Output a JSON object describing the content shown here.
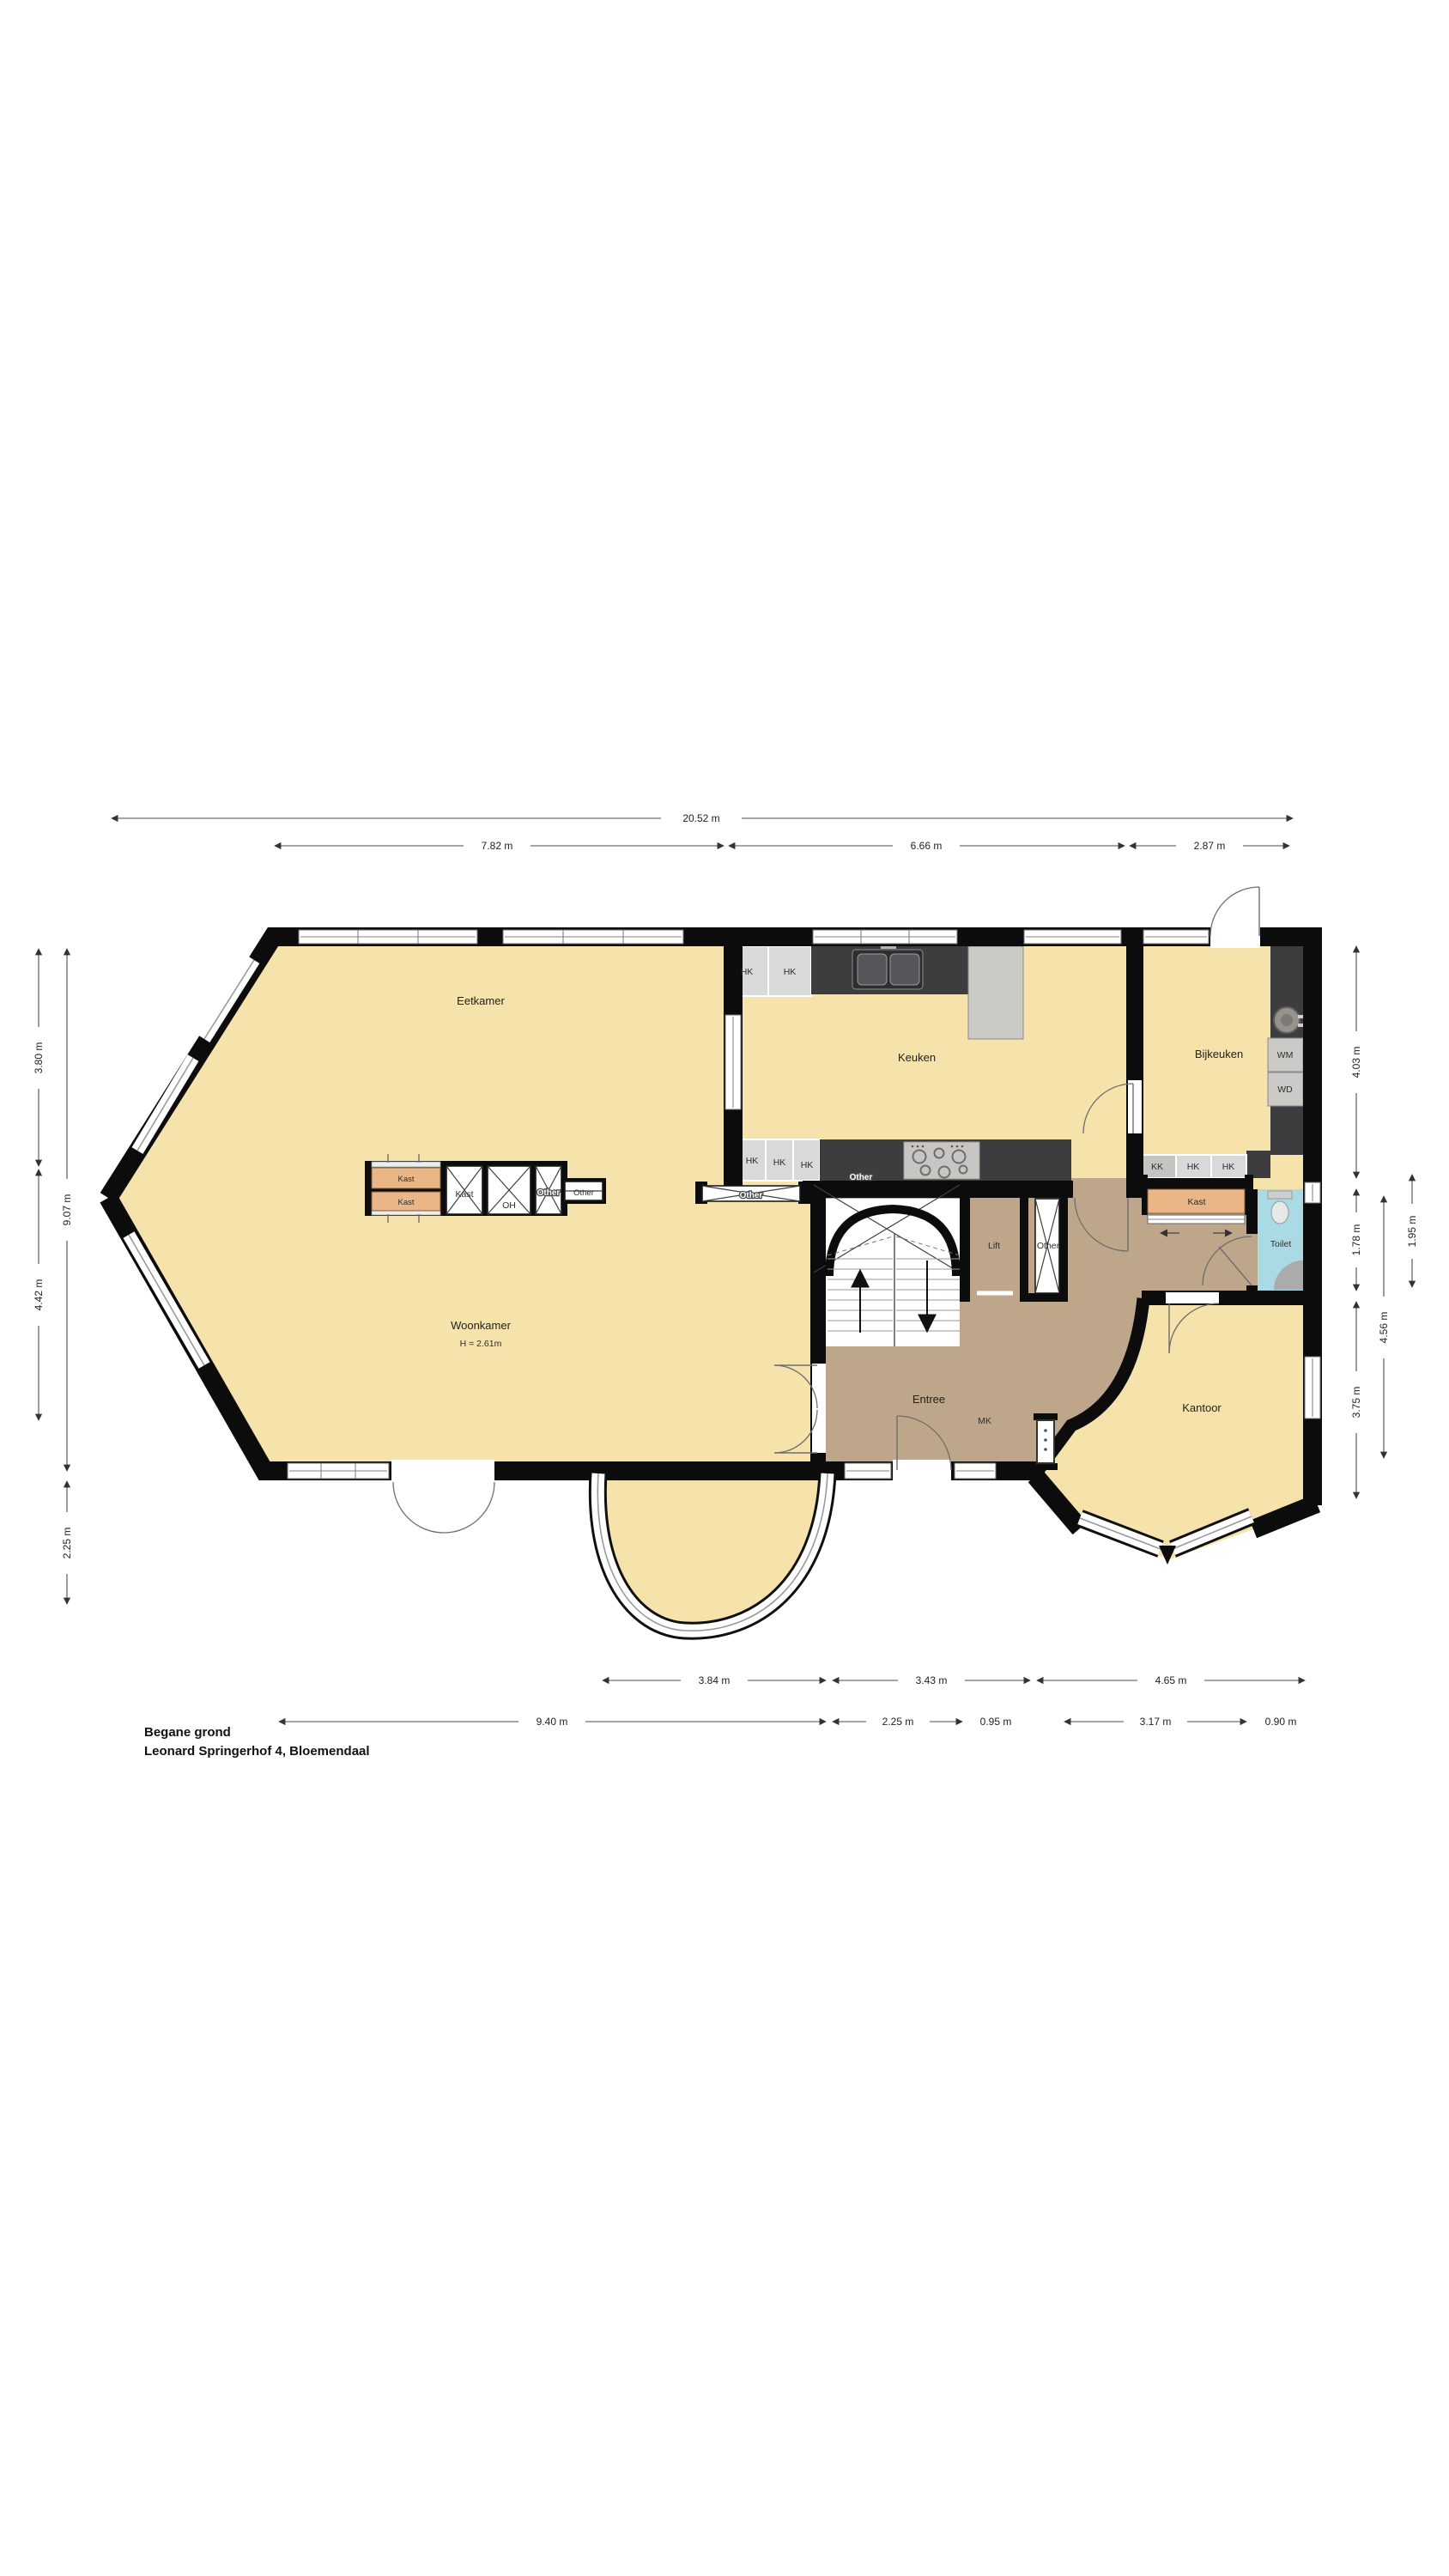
{
  "title": {
    "line1": "Begane grond",
    "line2": "Leonard Springerhof 4, Bloemendaal"
  },
  "labels": {
    "eetkamer": "Eetkamer",
    "keuken": "Keuken",
    "bijkeuken": "Bijkeuken",
    "woonkamer": "Woonkamer",
    "woonkamer_height": "H = 2.61m",
    "entree": "Entree",
    "kantoor": "Kantoor",
    "toilet": "Toilet",
    "lift": "Lift",
    "kast": "Kast",
    "mk": "MK",
    "oh": "OH",
    "other": "Other",
    "hk": "HK",
    "kk": "KK",
    "wm": "WM",
    "wd": "WD"
  },
  "dimensions": {
    "top": [
      "20.52 m",
      "7.82 m",
      "6.66 m",
      "2.87 m"
    ],
    "bottom_upper": [
      "3.84 m",
      "3.43 m",
      "4.65 m"
    ],
    "bottom_lower": [
      "9.40 m",
      "2.25 m",
      "0.95 m",
      "3.17 m",
      "0.90 m"
    ],
    "left": [
      "3.80 m",
      "4.42 m",
      "9.07 m",
      "2.25 m"
    ],
    "right": [
      "4.03 m",
      "1.78 m",
      "3.75 m",
      "4.56 m",
      "1.95 m"
    ]
  },
  "colors": {
    "floor": "#F5E3AB",
    "hall": "#BDA689",
    "kast": "#EAB686",
    "toilet": "#AADBE5",
    "wall": "#0C0C0C",
    "counter": "#3D3D3F",
    "cabinet": "#D9D9D9"
  }
}
